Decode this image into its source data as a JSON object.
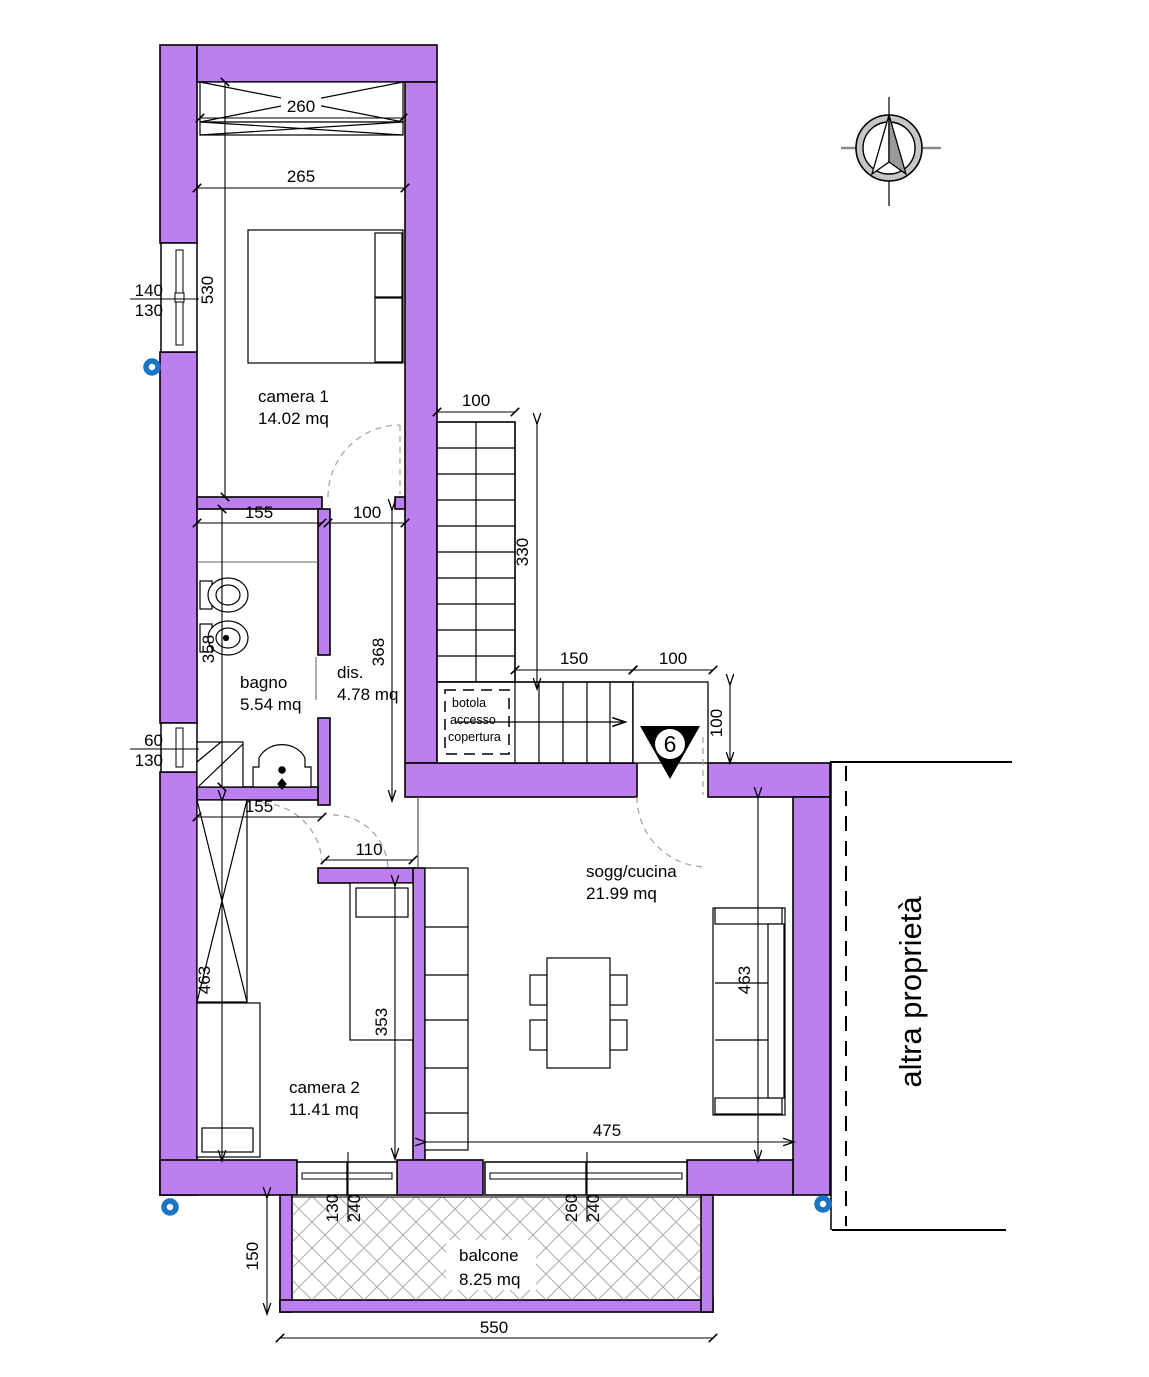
{
  "rooms": {
    "camera1": {
      "name": "camera 1",
      "area": "14.02 mq"
    },
    "bagno": {
      "name": "bagno",
      "area": "5.54 mq"
    },
    "dis": {
      "name": "dis.",
      "area": "4.78 mq"
    },
    "camera2": {
      "name": "camera 2",
      "area": "11.41 mq"
    },
    "soggiorno": {
      "name": "sogg/cucina",
      "area": "21.99 mq"
    },
    "balcone": {
      "name": "balcone",
      "area": "8.25 mq"
    }
  },
  "annotations": {
    "altra_proprieta": "altra proprietà",
    "botola_line1": "botola",
    "botola_line2": "accesso",
    "botola_line3": "copertura",
    "entrance_number": "6"
  },
  "dims": {
    "cam1_wardrobe": "260",
    "cam1_width": "265",
    "cam1_height": "530",
    "win1_w": "140",
    "win1_h": "130",
    "win2_w": "60",
    "win2_h": "130",
    "cam1_south": "155",
    "cam1_door": "100",
    "bagno_height": "358",
    "dis_height": "368",
    "bagno_south": "155",
    "stair_width": "100",
    "stair_run": "330",
    "stair_lower_run": "150",
    "entry_landing_w": "100",
    "entry_landing_h": "100",
    "cam2_opening": "110",
    "cam2_height": "463",
    "cam2_bed": "353",
    "sogg_height": "463",
    "sogg_width": "475",
    "win3_w": "130",
    "win3_h": "240",
    "win4_w": "260",
    "win4_h": "240",
    "balc_depth": "150",
    "balc_width": "550"
  },
  "colors": {
    "wall": "#bd7ff0",
    "hatch": "#adadad",
    "blue_marker": "#1b74c5",
    "compass_ring": "#c6c6c6",
    "needle_fill": "#9a9a9a"
  }
}
